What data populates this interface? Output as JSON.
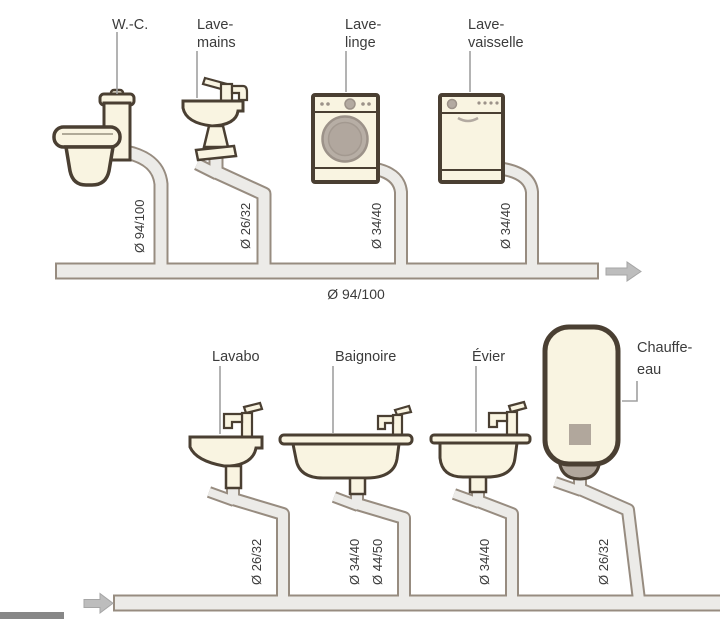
{
  "diagram": {
    "description_type": "plumbing-drainage-diameters-diagram",
    "colors": {
      "background": "#ffffff",
      "fixture_fill": "#f9f4e1",
      "fixture_outline": "#4a3f32",
      "pipe_fill": "#ecebe8",
      "pipe_stroke": "#978c80",
      "appliance_gray": "#b3aaa1",
      "arrow_gray": "#bdbdbd",
      "text": "#3b3b3b",
      "bottom_bar": "#878787"
    },
    "top_row": {
      "wc": {
        "label": "W.-C.",
        "pipe_diameter": "Ø 94/100"
      },
      "lave_mains": {
        "label_line1": "Lave-",
        "label_line2": "mains",
        "pipe_diameter": "Ø 26/32"
      },
      "lave_linge": {
        "label_line1": "Lave-",
        "label_line2": "linge",
        "pipe_diameter": "Ø 34/40"
      },
      "lave_vaisselle": {
        "label_line1": "Lave-",
        "label_line2": "vaisselle",
        "pipe_diameter": "Ø 34/40"
      },
      "collector_diameter": "Ø 94/100"
    },
    "bottom_row": {
      "lavabo": {
        "label": "Lavabo",
        "pipe_diameter": "Ø 26/32"
      },
      "baignoire": {
        "label": "Baignoire",
        "pipe_diameter_1": "Ø 34/40",
        "pipe_diameter_2": "Ø 44/50"
      },
      "evier": {
        "label": "Évier",
        "pipe_diameter": "Ø 34/40"
      },
      "chauffe_eau": {
        "label_line1": "Chauffe-",
        "label_line2": "eau",
        "pipe_diameter": "Ø 26/32"
      }
    }
  }
}
